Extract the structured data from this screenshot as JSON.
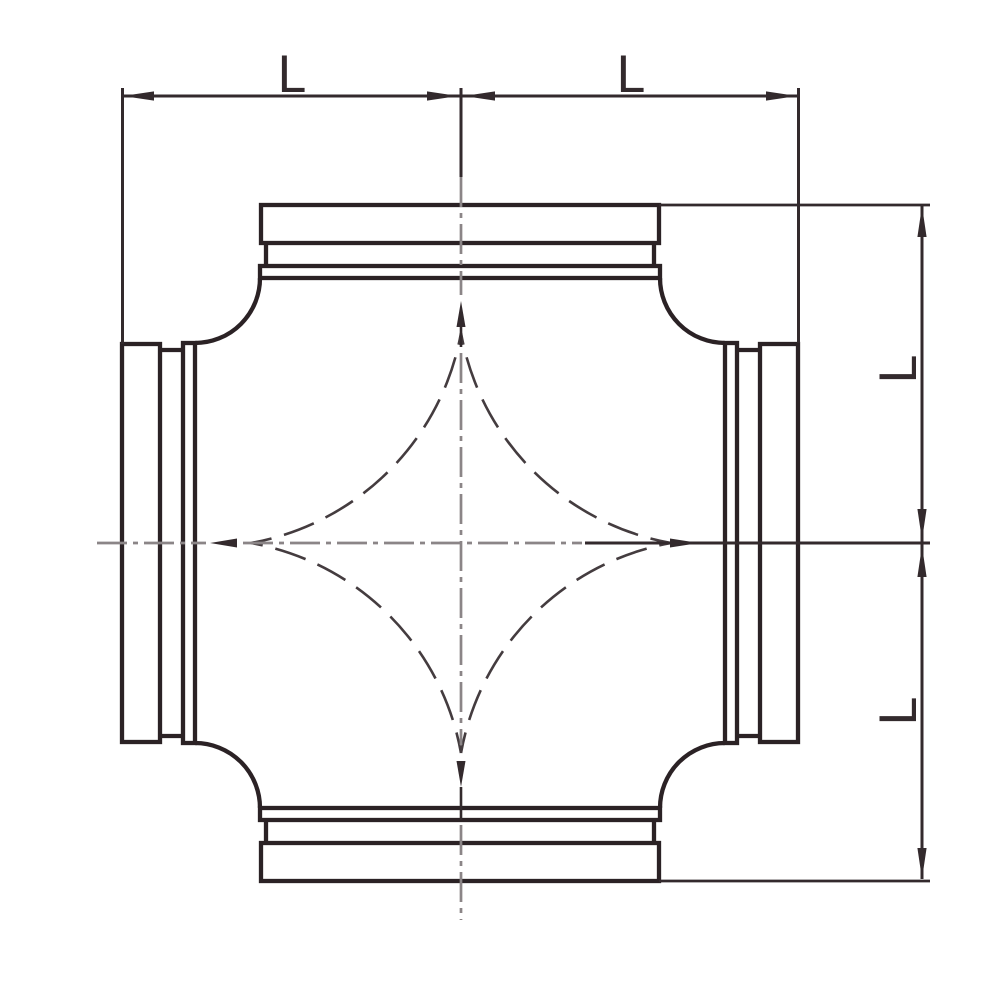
{
  "labels": {
    "dim_top_left": "L",
    "dim_top_right": "L",
    "dim_right_upper": "L",
    "dim_right_lower": "L"
  },
  "colors": {
    "background": "#ffffff",
    "outline": "#2b2225",
    "dimension": "#332a2d",
    "centerline": "#8b8587",
    "hidden_arc": "#443c3f"
  }
}
